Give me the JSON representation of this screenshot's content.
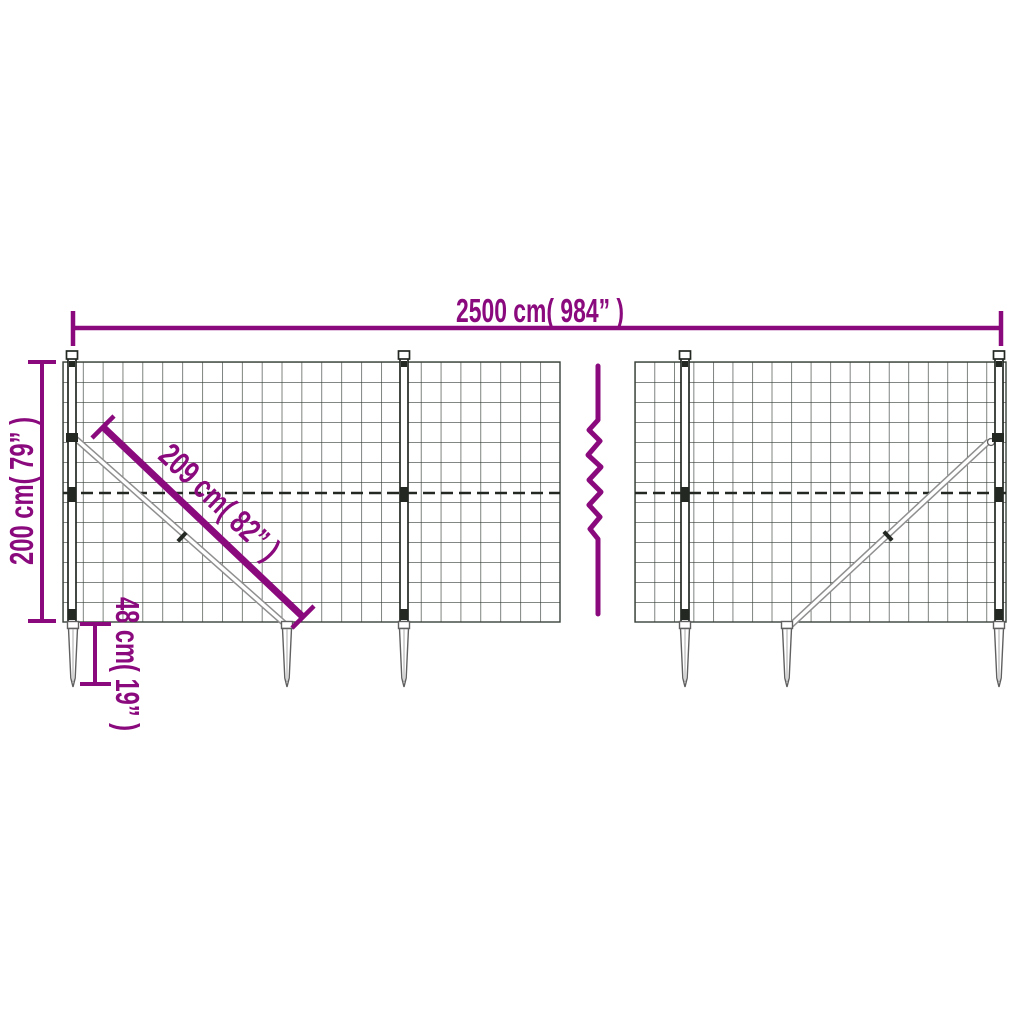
{
  "page": {
    "background": "#ffffff"
  },
  "diagram": {
    "type": "product-dimension-diagram",
    "subject": "wire mesh fence with ground anchor spikes",
    "colors": {
      "dimension": "#8a0a7e",
      "mesh": "#39413a",
      "frame": "#232823",
      "hardware": "#8f8f8f",
      "spike": "#606060",
      "spike_inner": "#a8a8a8",
      "white": "#ffffff"
    },
    "labels": {
      "total_width": "2500 cm( 984” )",
      "height": "200 cm( 79” )",
      "brace_length": "209 cm( 82” )",
      "anchor_depth": "48 cm( 19” )"
    }
  }
}
